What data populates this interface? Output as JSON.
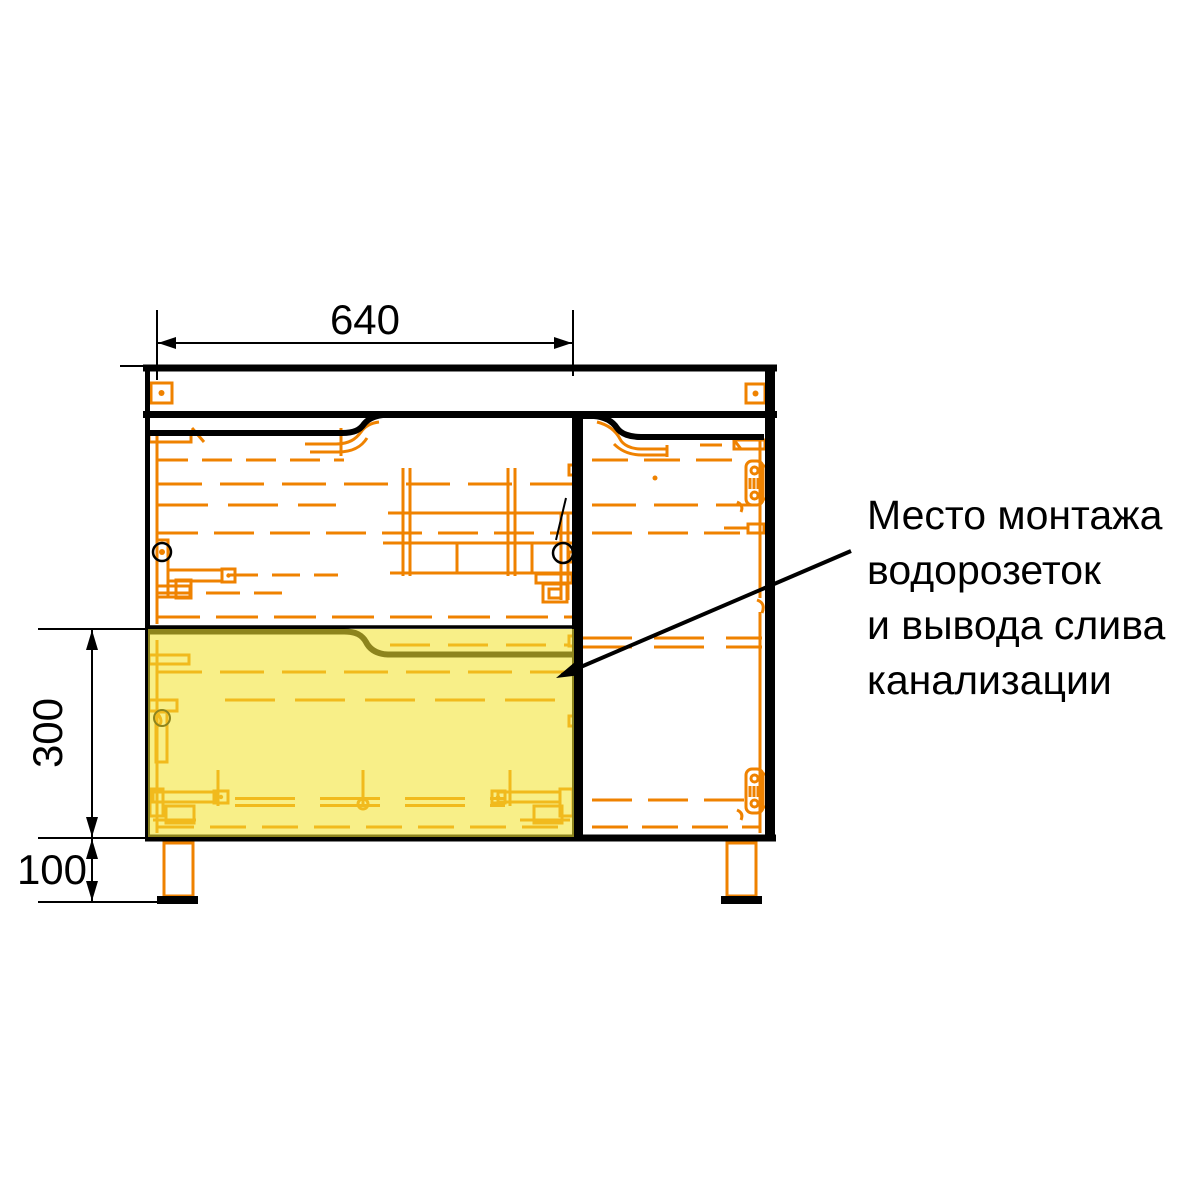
{
  "drawing": {
    "dimension_labels": {
      "top_width": "640",
      "drawer_section_height": "300",
      "leg_height": "100"
    },
    "annotation_lines": [
      "Место монтажа",
      "водорозеток",
      "и вывода слива",
      "канализации"
    ],
    "colors": {
      "outline": "#000000",
      "hidden_lines": "#EF8200",
      "highlight_fill": "#F3E432",
      "background": "#FFFFFF"
    }
  }
}
